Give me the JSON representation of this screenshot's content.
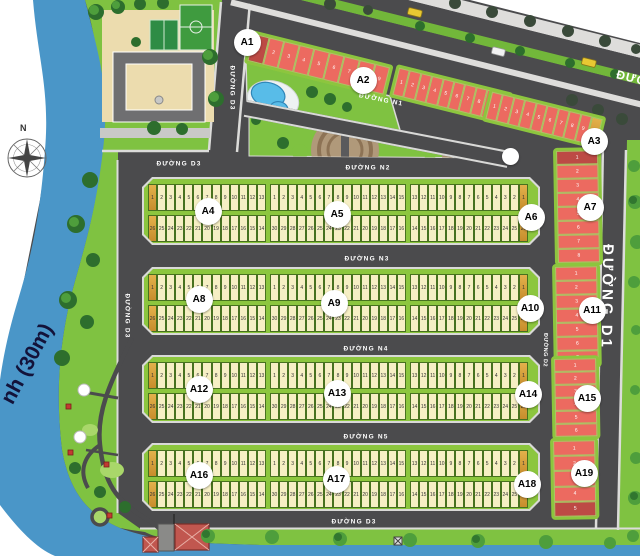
{
  "compass_label": "N",
  "river_label": "nh (30m)",
  "main_road_label_partial": "ĐƯỜ",
  "streets": {
    "d3_top": "ĐƯỜNG D3",
    "d3_mid": "ĐƯỜNG D3",
    "n1": "ĐƯỜNG N1",
    "n2": "ĐƯỜNG N2",
    "n3": "ĐƯỜNG N3",
    "n4": "ĐƯỜNG N4",
    "n5": "ĐƯỜNG N5",
    "d3_left": "ĐƯỜNG D3",
    "d3_bottom": "ĐƯỜNG D3",
    "d2": "ĐƯỜNG D2",
    "d1": "ĐƯỜNG D1"
  },
  "diagonal_blocks": [
    {
      "label": "A1",
      "plots": [
        "1",
        "2",
        "3",
        "4",
        "5",
        "6",
        "7",
        "8",
        "9"
      ]
    },
    {
      "label": "A2",
      "plots": [
        "1",
        "2",
        "3",
        "4",
        "5",
        "6",
        "7",
        "8",
        "9",
        "10"
      ]
    },
    {
      "label": "A3",
      "plots": [
        "1",
        "2",
        "3",
        "4",
        "5",
        "6",
        "7",
        "8",
        "9"
      ]
    }
  ],
  "vertical_blocks": [
    {
      "label": "A7",
      "plots": [
        "1",
        "2",
        "3",
        "4",
        "5",
        "6",
        "7",
        "8"
      ]
    },
    {
      "label": "A11",
      "plots": [
        "1",
        "2",
        "3",
        "4",
        "5",
        "6",
        "7"
      ]
    },
    {
      "label": "A15",
      "plots": [
        "1",
        "2",
        "3",
        "4",
        "5",
        "6"
      ]
    },
    {
      "label": "A19",
      "plots": [
        "1",
        "2",
        "3",
        "4",
        "5"
      ]
    }
  ],
  "band_rows": [
    {
      "blocks": [
        {
          "label": "A4",
          "top": [
            "1",
            "2",
            "3",
            "4",
            "5",
            "6",
            "7",
            "8",
            "9",
            "10",
            "11",
            "12",
            "13"
          ],
          "bottom": [
            "26",
            "25",
            "24",
            "23",
            "22",
            "21",
            "20",
            "19",
            "18",
            "17",
            "16",
            "15",
            "14"
          ]
        },
        {
          "label": "A5",
          "top": [
            "1",
            "2",
            "3",
            "4",
            "5",
            "6",
            "7",
            "8",
            "9",
            "10",
            "11",
            "12",
            "13",
            "14",
            "15"
          ],
          "bottom": [
            "30",
            "29",
            "28",
            "27",
            "26",
            "25",
            "24",
            "23",
            "22",
            "21",
            "20",
            "19",
            "18",
            "17",
            "16"
          ]
        },
        {
          "label": "A6",
          "top": [
            "13",
            "12",
            "11",
            "10",
            "9",
            "8",
            "7",
            "6",
            "5",
            "4",
            "3",
            "2",
            "1"
          ],
          "bottom": [
            "14",
            "15",
            "16",
            "17",
            "18",
            "19",
            "20",
            "21",
            "22",
            "23",
            "24",
            "25",
            "26"
          ]
        }
      ]
    },
    {
      "blocks": [
        {
          "label": "A8",
          "top": [
            "1",
            "2",
            "3",
            "4",
            "5",
            "6",
            "7",
            "8",
            "9",
            "10",
            "11",
            "12",
            "13"
          ],
          "bottom": [
            "26",
            "25",
            "24",
            "23",
            "22",
            "21",
            "20",
            "19",
            "18",
            "17",
            "16",
            "15",
            "14"
          ]
        },
        {
          "label": "A9",
          "top": [
            "1",
            "2",
            "3",
            "4",
            "5",
            "6",
            "7",
            "8",
            "9",
            "10",
            "11",
            "12",
            "13",
            "14",
            "15"
          ],
          "bottom": [
            "30",
            "29",
            "28",
            "27",
            "26",
            "25",
            "24",
            "23",
            "22",
            "21",
            "20",
            "19",
            "18",
            "17",
            "16"
          ]
        },
        {
          "label": "A10",
          "top": [
            "13",
            "12",
            "11",
            "10",
            "9",
            "8",
            "7",
            "6",
            "5",
            "4",
            "3",
            "2",
            "1"
          ],
          "bottom": [
            "14",
            "15",
            "16",
            "17",
            "18",
            "19",
            "20",
            "21",
            "22",
            "23",
            "24",
            "25",
            "26"
          ]
        }
      ]
    },
    {
      "blocks": [
        {
          "label": "A12",
          "top": [
            "1",
            "2",
            "3",
            "4",
            "5",
            "6",
            "7",
            "8",
            "9",
            "10",
            "11",
            "12",
            "13"
          ],
          "bottom": [
            "26",
            "25",
            "24",
            "23",
            "22",
            "21",
            "20",
            "19",
            "18",
            "17",
            "16",
            "15",
            "14"
          ]
        },
        {
          "label": "A13",
          "top": [
            "1",
            "2",
            "3",
            "4",
            "5",
            "6",
            "7",
            "8",
            "9",
            "10",
            "11",
            "12",
            "13",
            "14",
            "15"
          ],
          "bottom": [
            "30",
            "29",
            "28",
            "27",
            "26",
            "25",
            "24",
            "23",
            "22",
            "21",
            "20",
            "19",
            "18",
            "17",
            "16"
          ]
        },
        {
          "label": "A14",
          "top": [
            "13",
            "12",
            "11",
            "10",
            "9",
            "8",
            "7",
            "6",
            "5",
            "4",
            "3",
            "2",
            "1"
          ],
          "bottom": [
            "14",
            "15",
            "16",
            "17",
            "18",
            "19",
            "20",
            "21",
            "22",
            "23",
            "24",
            "25",
            "26"
          ]
        }
      ]
    },
    {
      "blocks": [
        {
          "label": "A16",
          "top": [
            "1",
            "2",
            "3",
            "4",
            "5",
            "6",
            "7",
            "8",
            "9",
            "10",
            "11",
            "12",
            "13"
          ],
          "bottom": [
            "26",
            "25",
            "24",
            "23",
            "22",
            "21",
            "20",
            "19",
            "18",
            "17",
            "16",
            "15",
            "14"
          ]
        },
        {
          "label": "A17",
          "top": [
            "1",
            "2",
            "3",
            "4",
            "5",
            "6",
            "7",
            "8",
            "9",
            "10",
            "11",
            "12",
            "13",
            "14",
            "15"
          ],
          "bottom": [
            "30",
            "29",
            "28",
            "27",
            "26",
            "25",
            "24",
            "23",
            "22",
            "21",
            "20",
            "19",
            "18",
            "17",
            "16"
          ]
        },
        {
          "label": "A18",
          "top": [
            "13",
            "12",
            "11",
            "10",
            "9",
            "8",
            "7",
            "6",
            "5",
            "4",
            "3",
            "2",
            "1"
          ],
          "bottom": [
            "14",
            "15",
            "16",
            "17",
            "18",
            "19",
            "20",
            "21",
            "22",
            "23",
            "24",
            "25",
            "26"
          ]
        }
      ]
    }
  ],
  "colors": {
    "river": "#4a96c8",
    "road": "#4b4b4d",
    "grass": "#7fc241",
    "platform": "#8cc63e",
    "plot_yellow": "#f6efc4",
    "plot_corner_orange": "#d9a23a",
    "plot_red": "#ec6a60",
    "plot_red_dark": "#bd4a45",
    "sidewalk": "#dcdcda"
  }
}
